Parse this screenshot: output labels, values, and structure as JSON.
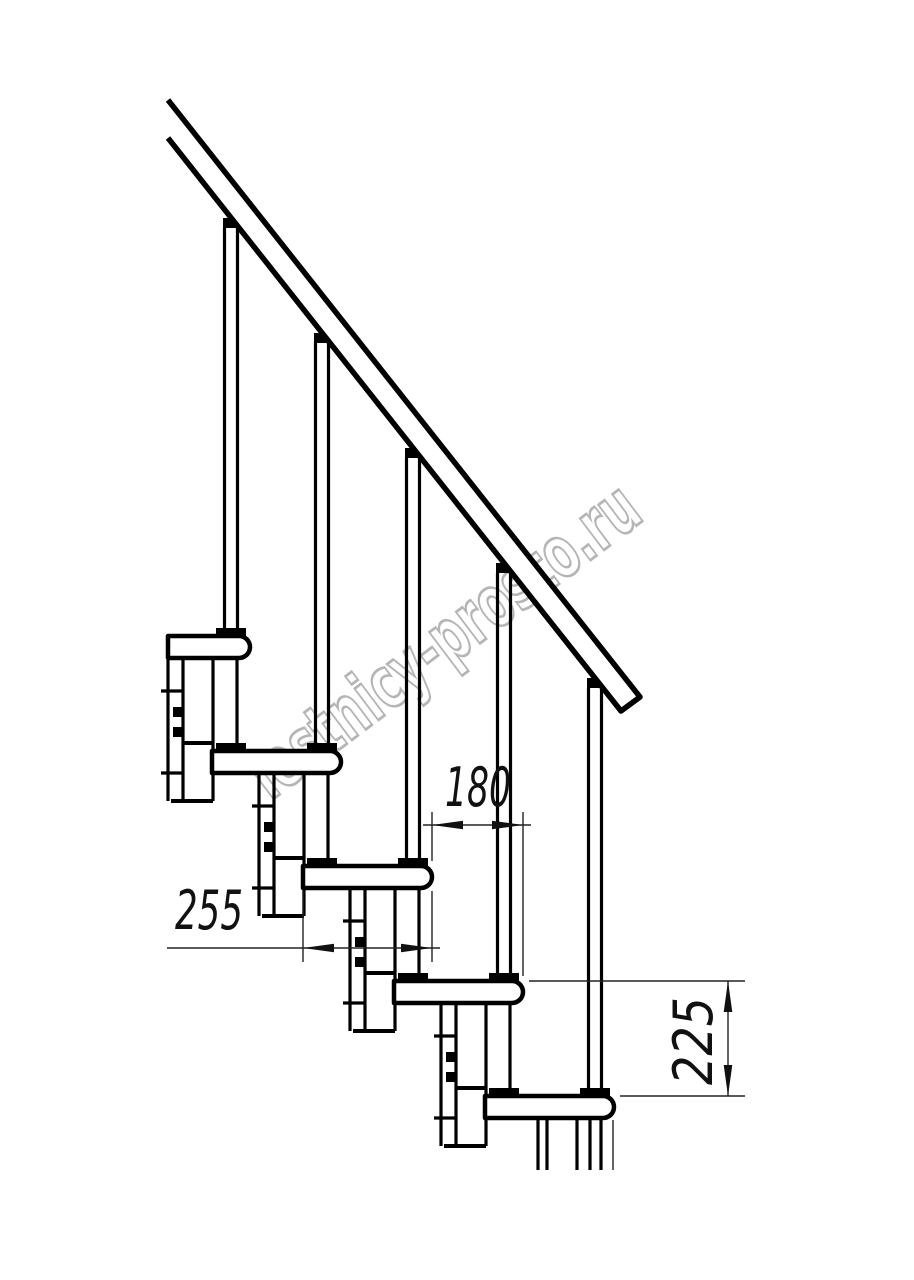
{
  "drawing": {
    "description": "Modular staircase side-view technical drawing",
    "colors": {
      "background": "#ffffff",
      "line": "#000000",
      "dimension": "#111111",
      "watermark": "#a3a3a3"
    }
  },
  "dimensions": {
    "step_run": {
      "value": "180",
      "orientation": "horizontal"
    },
    "tread_depth": {
      "value": "255",
      "orientation": "horizontal"
    },
    "step_rise": {
      "value": "225",
      "orientation": "vertical"
    }
  },
  "watermark": {
    "text": "lestnicy-prosto.ru"
  }
}
